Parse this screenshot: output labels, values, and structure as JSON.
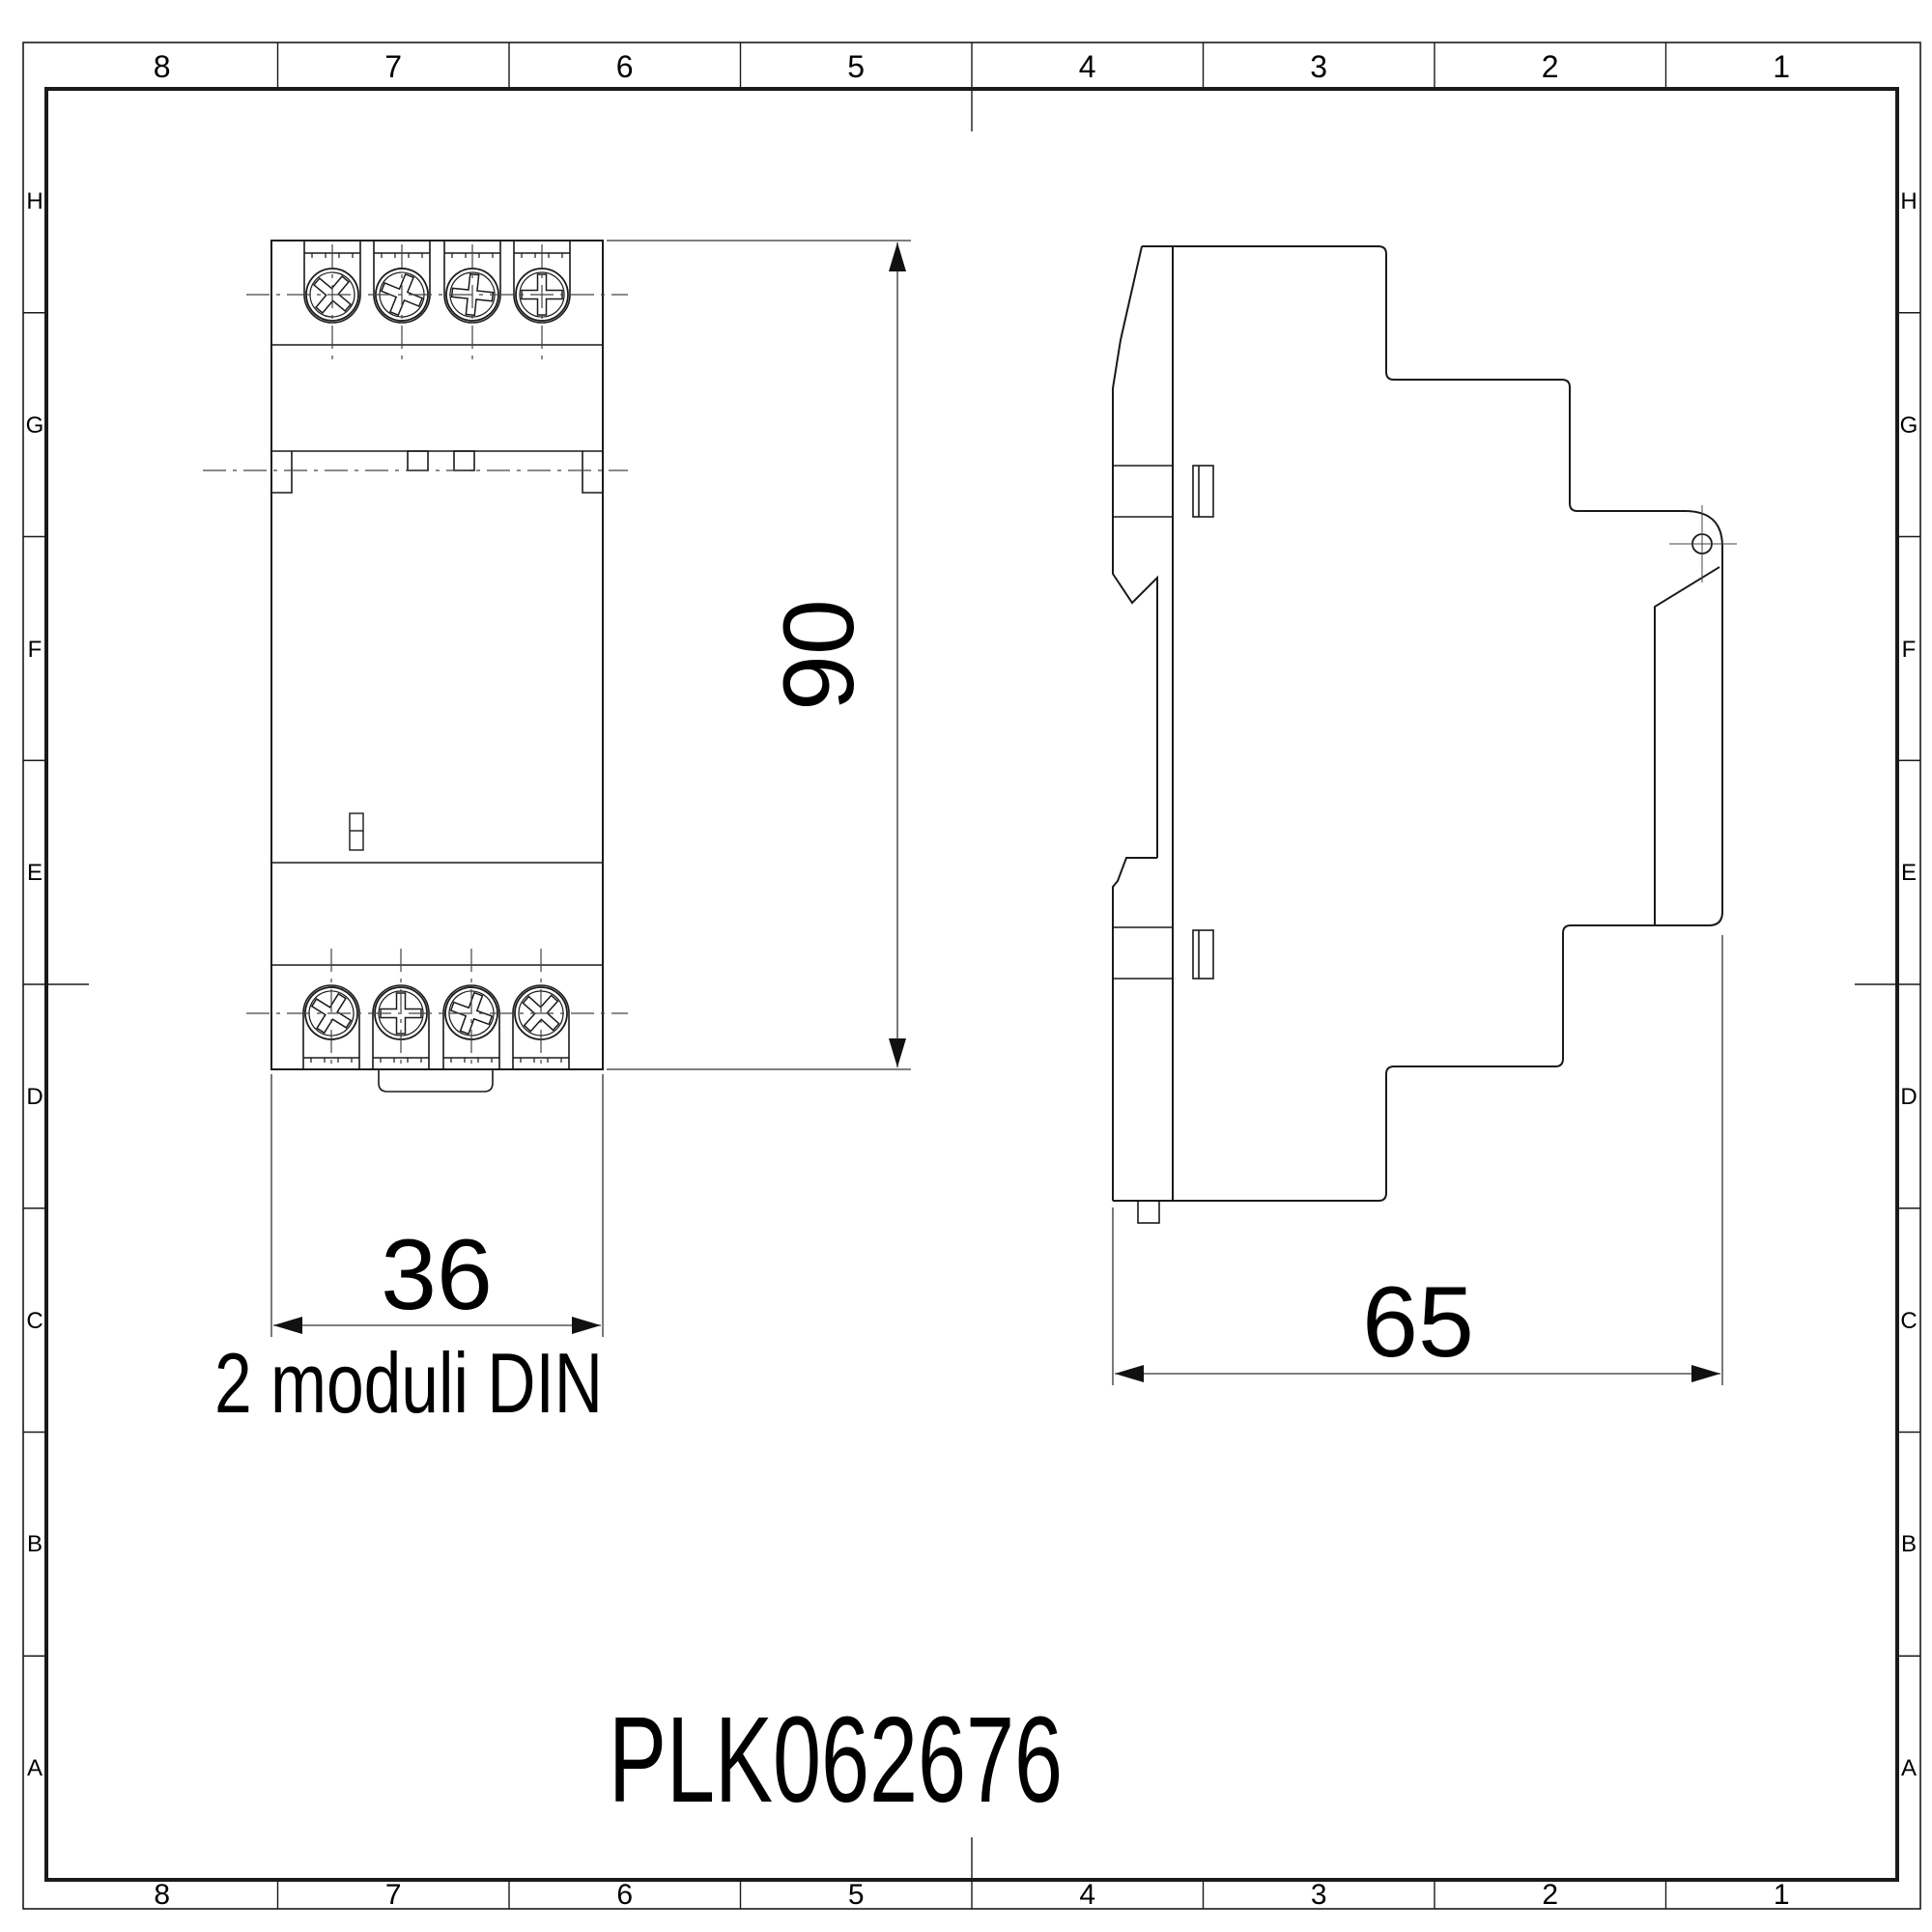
{
  "colors": {
    "background": "#ffffff",
    "line": "#1a1a1a",
    "text": "#000000"
  },
  "border": {
    "columns": [
      "8",
      "7",
      "6",
      "5",
      "4",
      "3",
      "2",
      "1"
    ],
    "rows": [
      "H",
      "G",
      "F",
      "E",
      "D",
      "C",
      "B",
      "A"
    ]
  },
  "front_view": {
    "width_dim": "36",
    "height_dim": "90",
    "width_note": "2 moduli DIN"
  },
  "side_view": {
    "depth_dim": "65"
  },
  "title_block": {
    "part_number": "PLK062676"
  }
}
